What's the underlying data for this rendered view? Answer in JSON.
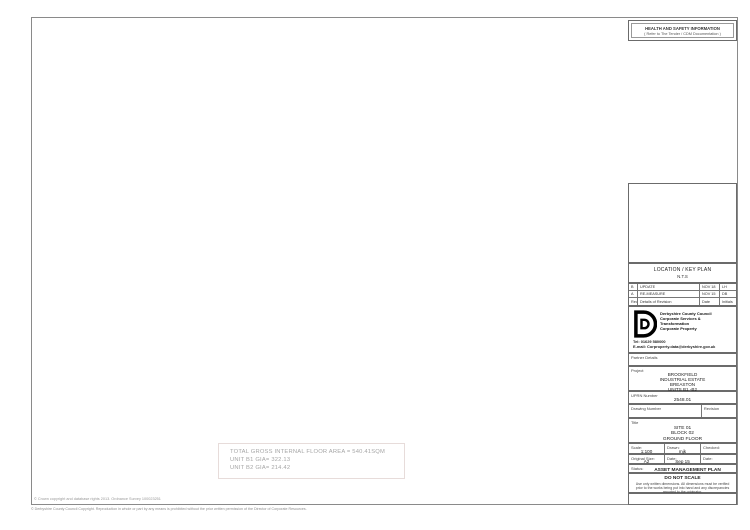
{
  "sheet": {
    "health_safety": {
      "title": "HEALTH AND SAFETY INFORMATION",
      "subtitle": "( Refer to The Tender / CDM Documentation )"
    },
    "titleblock": {
      "location": {
        "title": "LOCATION / KEY PLAN",
        "scale": "N.T.S"
      },
      "revisions": {
        "rows": [
          {
            "rev": "B",
            "details": "UPDATE",
            "date": "NOV 18",
            "initials": "LH"
          },
          {
            "rev": "A",
            "details": "RE-MEASURE",
            "date": "NOV 15",
            "initials": "DB"
          }
        ],
        "header": {
          "rev": "Rev.",
          "details": "Details of Revision",
          "date": "Date",
          "initials": "Initials"
        }
      },
      "org": {
        "name": "Derbyshire County Council",
        "dept1": "Corporate Services &",
        "dept2": "Transformation",
        "dept3": "Corporate Property",
        "tel": "Tel: 01629 580000",
        "email": "E-mail: Corproperty.data@derbyshire.gov.uk",
        "partner_label": "Partner Details"
      },
      "project": {
        "label": "Project",
        "line1": "BROOKFIELD",
        "line2": "INDUSTRIAL ESTATE",
        "line3": "BREASTON",
        "line4": "UNITS B1 -B2"
      },
      "uprn": {
        "label": "UPRN Number",
        "value": "2548.01"
      },
      "drawing": {
        "label": "Drawing Number",
        "revision_label": "Revision"
      },
      "title": {
        "label": "Title",
        "line1": "SITE 01",
        "line2": "BLOCK 02",
        "line3": "GROUND FLOOR"
      },
      "meta": {
        "scale_label": "Scale:",
        "scale": "1:100",
        "drawn_label": "Drawn:",
        "drawn": "mjk",
        "checked_label": "Checked:",
        "checked": "",
        "size_label": "Original Size:",
        "size": "A2",
        "date_label": "Date:",
        "date": "Sep 15",
        "date2_label": "Date:",
        "date2": "",
        "status_label": "Status:",
        "status": "ASSET MANAGEMENT PLAN"
      },
      "do_not_scale": {
        "title": "DO NOT SCALE",
        "note": "Use only written dimensions. All dimensions must be verified prior to the works being put into hand and any discrepancies reported to the originator."
      }
    }
  },
  "plan": {
    "unit_b1_label": "UNIT B1",
    "unit_b2_label": "UNIT B2",
    "rooms": [
      {
        "number": "011",
        "type": "WS"
      },
      {
        "number": "005",
        "type": "WS"
      },
      {
        "number": "017",
        "type": "OF"
      },
      {
        "number": "015",
        "type": "CA"
      },
      {
        "number": "009",
        "type": "OF"
      },
      {
        "number": "007",
        "type": "WM"
      },
      {
        "number": "006",
        "type": "WF"
      },
      {
        "number": "002",
        "type": "WM"
      },
      {
        "number": "001",
        "type": "WF"
      },
      {
        "number": "003",
        "type": "CA"
      },
      {
        "number": "016",
        "type": "CA"
      }
    ]
  },
  "areas": {
    "line1": "TOTAL GROSS INTERNAL FLOOR AREA = 540.41SQM",
    "line2": "UNIT B1 GIA= 322.13",
    "line3": "UNIT B2 GIA= 214.42"
  },
  "footer": {
    "crown": "© Crown copyright and database rights 2013. Ordnance Survey 100023251",
    "council": "© Derbyshire County Council Copyright. Reproduction in whole or part by any means is prohibited without the prior written permission of the Director of Corporate Resources."
  },
  "colors": {
    "wall": "#4a4a4a",
    "highlight": "#f5f2b8",
    "area_text": "#a6a6a6"
  }
}
